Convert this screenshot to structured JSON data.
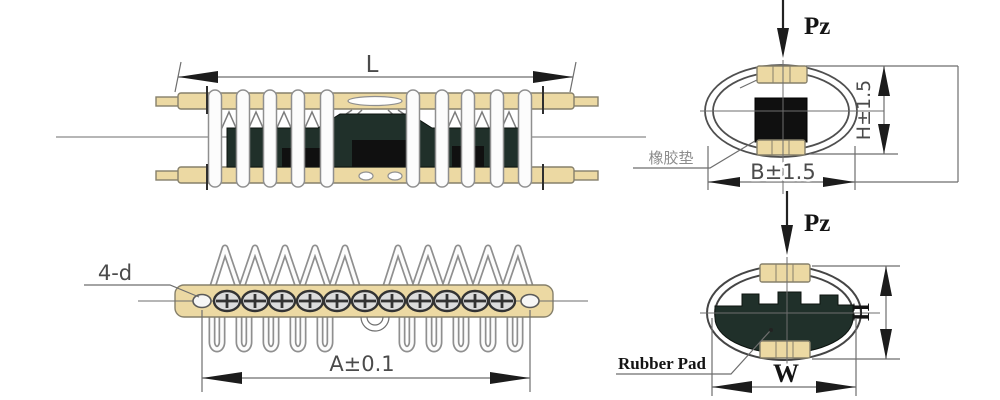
{
  "colors": {
    "background": "#ffffff",
    "bar_fill": "#ecd9a3",
    "bar_stroke": "#86806b",
    "wire_fill": "#fcfcfc",
    "wire_stroke": "#8f8f8f",
    "block_dark": "#20302a",
    "block_black": "#101010",
    "line": "#6e6e6e",
    "arrow": "#1c1c1c",
    "dim_text": "#4b4b4b",
    "label_text": "#141414",
    "cn_text": "#8c8c8c",
    "screw": "#333333",
    "screw_fill": "#dcdcdc",
    "ellipse_stroke": "#4f4f4f"
  },
  "side_view": {
    "dim_length": "L"
  },
  "plan_view": {
    "hole_callout": "4-d",
    "dim_span": "A±0.1"
  },
  "end_view_top": {
    "load": "Pz",
    "dim_height": "H±1.5",
    "dim_width": "B±1.5",
    "rubber_pad": "橡胶垫"
  },
  "end_view_bottom": {
    "load": "Pz",
    "dim_height": "H",
    "dim_width": "W",
    "rubber_pad": "Rubber Pad"
  }
}
